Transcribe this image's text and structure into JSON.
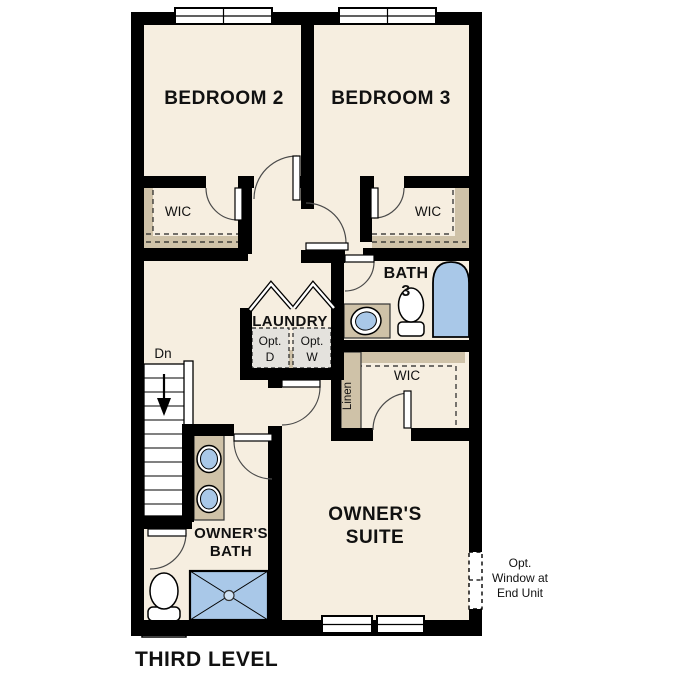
{
  "plan": {
    "title": "THIRD LEVEL",
    "labels": {
      "bedroom2": "BEDROOM 2",
      "bedroom3": "BEDROOM 3",
      "wic_bedroom2": "WIC",
      "wic_bedroom3": "WIC",
      "bath3_l1": "BATH",
      "bath3_l2": "3",
      "laundry": "LAUNDRY",
      "opt_dryer_l1": "Opt.",
      "opt_dryer_l2": "D",
      "opt_washer_l1": "Opt.",
      "opt_washer_l2": "W",
      "wic_owners": "WIC",
      "linen": "Linen",
      "stairs_direction": "Dn",
      "owners_bath_l1": "OWNER'S",
      "owners_bath_l2": "BATH",
      "owners_suite_l1": "OWNER'S",
      "owners_suite_l2": "SUITE"
    },
    "annotations": {
      "opt_window_l1": "Opt.",
      "opt_window_l2": "Window at",
      "opt_window_l3": "End Unit"
    },
    "colors": {
      "wall": "#000000",
      "floor": "#f6eee0",
      "casework": "#cfc2a8",
      "fixture_blue": "#a9c8e8",
      "stairs": "#ffffff",
      "opt_box": "#e4e2dd"
    }
  }
}
